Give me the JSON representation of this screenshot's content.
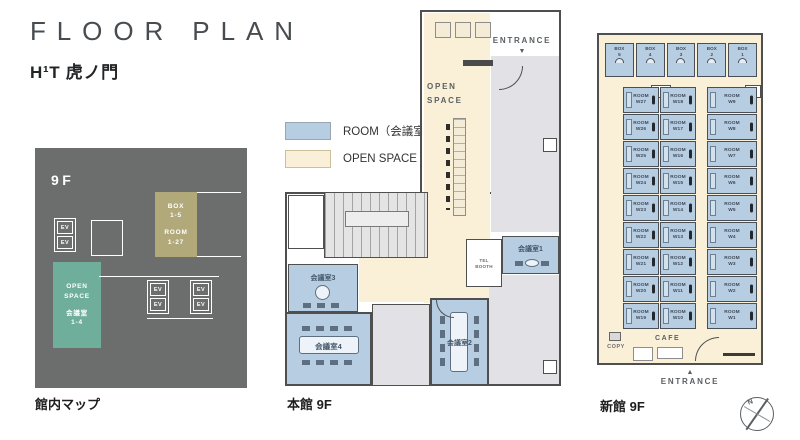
{
  "header": {
    "title": "FLOOR PLAN",
    "subtitle": "H¹T 虎ノ門"
  },
  "legend": {
    "items": [
      {
        "label": "ROOM（会議室）",
        "color": "#b7cde2"
      },
      {
        "label": "OPEN SPACE",
        "color": "#faf0d8"
      }
    ]
  },
  "site_map": {
    "floor": "9F",
    "caption": "館内マップ",
    "ev": "EV",
    "box_room_block": {
      "lines": [
        "BOX",
        "1-5",
        "ROOM",
        "1-27"
      ]
    },
    "open_block": {
      "lines": [
        "OPEN",
        "SPACE",
        "会議室",
        "1-4"
      ]
    },
    "colors": {
      "background": "#6b6e6d",
      "open_space": "#6fae9a",
      "box_room": "#b2a97b"
    }
  },
  "main_building": {
    "caption": "本館 9F",
    "entrance": "ENTRANCE",
    "entrance_arrow": "▼",
    "open_space": [
      "OPEN",
      "SPACE"
    ],
    "tel_booth": [
      "TEL",
      "BOOTH"
    ],
    "rooms": {
      "room1": "会議室1",
      "room2": "会議室2",
      "room3": "会議室3",
      "room4": "会議室4"
    }
  },
  "annex": {
    "caption": "新館 9F",
    "entrance": "ENTRANCE",
    "entrance_arrow": "▲",
    "cafe": "CAFE",
    "copy": "COPY",
    "box_word": "BOX",
    "room_word": "ROOM",
    "boxes": [
      "5",
      "4",
      "3",
      "2",
      "1"
    ],
    "rooms_left": [
      "W27",
      "W26",
      "W25",
      "W24",
      "W23",
      "W22",
      "W21",
      "W20",
      "W19"
    ],
    "rooms_mid": [
      "W18",
      "W17",
      "W16",
      "W15",
      "W14",
      "W13",
      "W12",
      "W11",
      "W10"
    ],
    "rooms_right": [
      "W9",
      "W8",
      "W7",
      "W6",
      "W5",
      "W4",
      "W3",
      "W2",
      "W1"
    ]
  },
  "compass": {
    "north": "N"
  }
}
